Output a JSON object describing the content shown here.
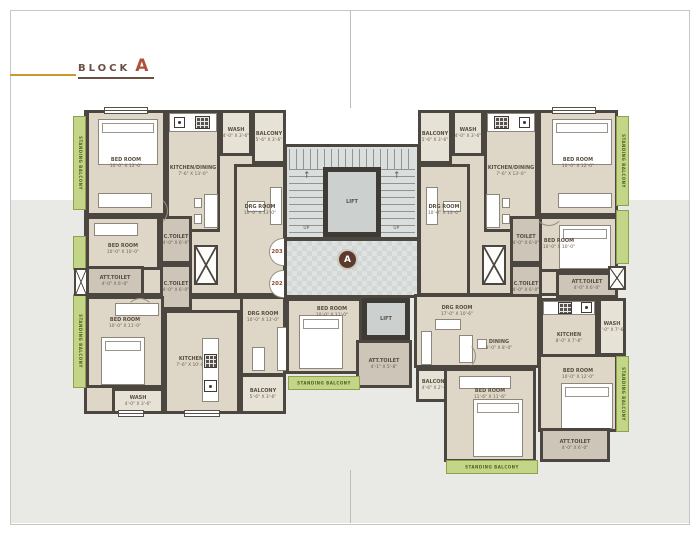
{
  "title": {
    "block": "BLOCK",
    "letter": "A"
  },
  "badge": {
    "letter": "A"
  },
  "core": {
    "lift_upper": "LIFT",
    "lift_lower": "LIFT",
    "up_label": "UP",
    "att_toilet": {
      "name": "ATT.TOILET",
      "dim": "4'-1\" X 5'-8\""
    }
  },
  "units": {
    "u203": "203",
    "u202": "202",
    "u204": "204",
    "u201": "201"
  },
  "labels": {
    "standing_balcony": "STANDING BALCONY"
  },
  "rooms": {
    "bed203a": {
      "name": "BED ROOM",
      "dim": "10'-0\" X 12'-0\""
    },
    "kitchen203": {
      "name": "KITCHEN/DINING",
      "dim": "7'-6\" X 13'-0\""
    },
    "wash203": {
      "name": "WASH",
      "dim": "4'-0\" X 3'-6\""
    },
    "balcony203": {
      "name": "BALCONY",
      "dim": "5'-6\" X 3'-6\""
    },
    "drg203": {
      "name": "DRG ROOM",
      "dim": "10'-0\" X 13'-0\""
    },
    "bed203b": {
      "name": "BED ROOM",
      "dim": "10'-0\" X 10'-0\""
    },
    "att203": {
      "name": "ATT.TOILET",
      "dim": "4'-0\" X 6'-0\""
    },
    "ctoilet203a": {
      "name": "C.TOILET",
      "dim": "4'-0\" X 6'-0\""
    },
    "ctoilet203b": {
      "name": "C.TOILET",
      "dim": "4'-0\" X 6'-0\""
    },
    "bed202": {
      "name": "BED ROOM",
      "dim": "10'-0\" X 11'-0\""
    },
    "wash202": {
      "name": "WASH",
      "dim": "4'-0\" X 3'-6\""
    },
    "kitchen202": {
      "name": "KITCHEN",
      "dim": "7'-6\" X 10'-0\""
    },
    "drg202": {
      "name": "DRG ROOM",
      "dim": "10'-0\" X 13'-0\""
    },
    "balcony202": {
      "name": "BALCONY",
      "dim": "5'-6\" X 3'-6\""
    },
    "bed202b": {
      "name": "BED ROOM",
      "dim": "10'-0\" X 11'-0\""
    },
    "balcony204": {
      "name": "BALCONY",
      "dim": "5'-6\" X 3'-6\""
    },
    "wash204": {
      "name": "WASH",
      "dim": "4'-0\" X 3'-6\""
    },
    "kitchen204": {
      "name": "KITCHEN/DINING",
      "dim": "7'-6\" X 13'-0\""
    },
    "bed204a": {
      "name": "BED ROOM",
      "dim": "10'-0\" X 12'-0\""
    },
    "drg204": {
      "name": "DRG ROOM",
      "dim": "10'-0\" X 13'-0\""
    },
    "bed204b": {
      "name": "BED ROOM",
      "dim": "10'-0\" X 10'-0\""
    },
    "toilet204": {
      "name": "TOILET",
      "dim": "4'-0\" X 6'-0\""
    },
    "ctoilet204": {
      "name": "C.TOILET",
      "dim": "4'-0\" X 6'-0\""
    },
    "att204": {
      "name": "ATT.TOILET",
      "dim": "4'-0\" X 6'-0\""
    },
    "drg201": {
      "name": "DRG ROOM",
      "dim": "17'-0\" X 10'-6\""
    },
    "dining201": {
      "name": "DINING",
      "dim": "8'-0\" X 8'-0\""
    },
    "kitchen201": {
      "name": "KITCHEN",
      "dim": "8'-0\" X 7'-6\""
    },
    "wash201": {
      "name": "WASH",
      "dim": "3'-0\" X 7'-6\""
    },
    "balcony201": {
      "name": "BALCONY",
      "dim": "4'-6\" X 2'-6\""
    },
    "bed201a": {
      "name": "BED ROOM",
      "dim": "11'-6\" X 11'-6\""
    },
    "bed201b": {
      "name": "BED ROOM",
      "dim": "10'-0\" X 12'-0\""
    },
    "att201": {
      "name": "ATT.TOILET",
      "dim": "4'-0\" X 6'-0\""
    }
  },
  "colors": {
    "wall": "#4b463f",
    "floor": "#ded7c8",
    "floor_light": "#e7e2d6",
    "toilet_floor": "#cdc5b8",
    "lobby": "#d9dddc",
    "lift": "#ccd0cf",
    "balcony_green": "#c3d687",
    "title_brown": "#6b4f41",
    "title_red": "#b0503c",
    "gold_line": "#c79b28",
    "unit_number": "#8a4a35",
    "page_gray": "#e9e9e6"
  }
}
